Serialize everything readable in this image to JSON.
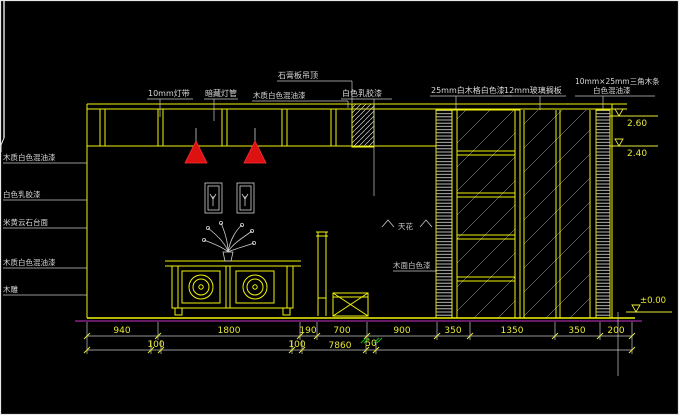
{
  "drawing": {
    "type": "interior-elevation-cad",
    "labels": {
      "top": [
        "10mm灯带",
        "暗藏灯管",
        "石膏板吊顶",
        "木质白色混油漆",
        "白色乳胶漆",
        "25mm白木格白色漆",
        "12mm玻璃搁板",
        "10mm×25mm三角木条",
        "白色混油漆"
      ],
      "left": [
        "木质白色混油漆",
        "白色乳胶漆",
        "米黄云石台面",
        "木质白色混油漆",
        "木雕"
      ],
      "inline": [
        "天花",
        "木面白色漆"
      ]
    },
    "levels": {
      "top": "2.60",
      "middle": "2.40",
      "floor": "±0.00"
    },
    "dimensions": {
      "row1": [
        "940",
        "1800",
        "190",
        "700",
        "900",
        "350",
        "1350",
        "350",
        "200"
      ],
      "row2": [
        "100",
        "100",
        "7860",
        "50"
      ]
    },
    "colors": {
      "background": "#000000",
      "line_yellow": "#f2f20c",
      "line_gray": "#c9c9c9",
      "dim_text": "#e8e838",
      "label_text": "#d9d9d9",
      "lamp_red": "#dd1111",
      "floor_magenta": "#cc33cc",
      "green_mark": "#18b418"
    }
  }
}
